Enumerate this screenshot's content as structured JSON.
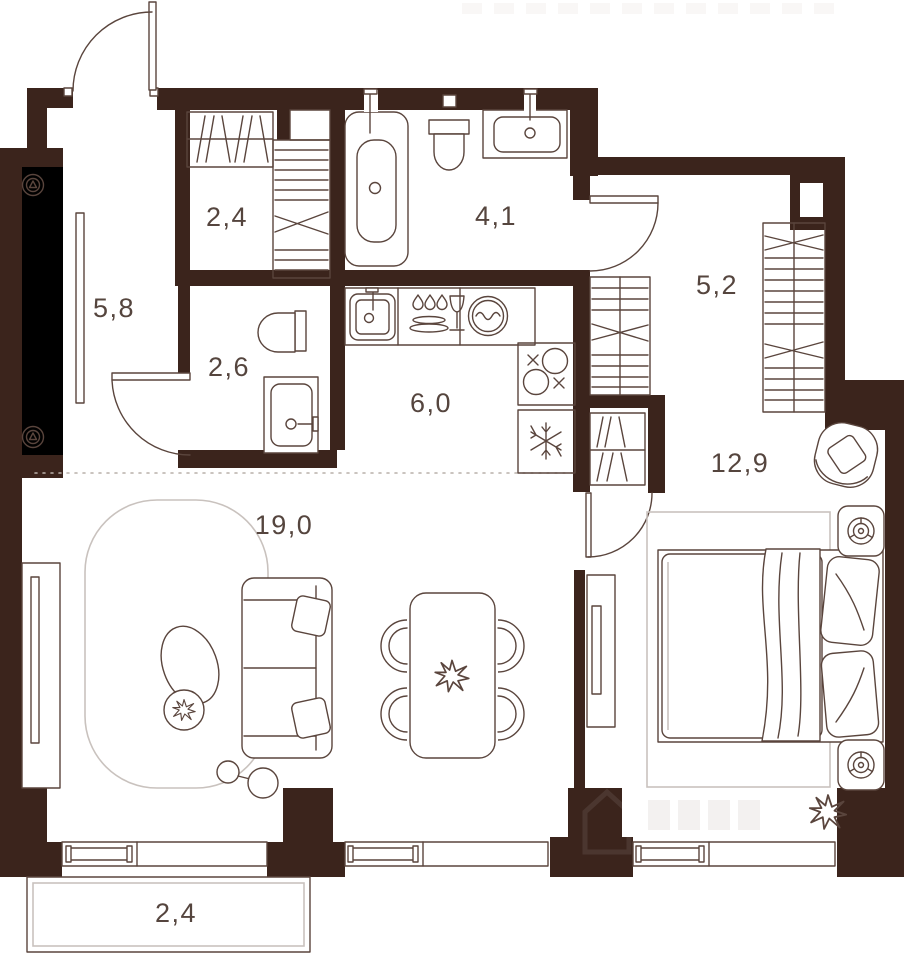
{
  "plan": {
    "name": "apartment-floor-plan",
    "colors": {
      "wall": "#3b241c",
      "furniture_line": "#5a453d",
      "light_line": "#c9c2be",
      "label": "#55453e",
      "background": "#ffffff"
    },
    "rooms": [
      {
        "id": "entry-hall",
        "label": "5,8"
      },
      {
        "id": "closet",
        "label": "2,4"
      },
      {
        "id": "bathroom",
        "label": "4,1"
      },
      {
        "id": "wc",
        "label": "2,6"
      },
      {
        "id": "kitchen",
        "label": "6,0"
      },
      {
        "id": "corridor",
        "label": "5,2"
      },
      {
        "id": "living-room",
        "label": "19,0"
      },
      {
        "id": "bedroom",
        "label": "12,9"
      },
      {
        "id": "balcony",
        "label": "2,4"
      }
    ],
    "icons": [
      "bathtub-icon",
      "toilet-icon",
      "sink-icon",
      "washing-machine-icon",
      "dishes-icon",
      "stove-icon",
      "snowflake-fridge-icon",
      "wardrobe-icon",
      "shelves-icon",
      "bed-icon",
      "pillow-icon",
      "sofa-icon",
      "dining-table-icon",
      "chair-icon",
      "armchair-icon",
      "plant-icon",
      "floor-lamp-icon",
      "tv-icon",
      "radiator-icon",
      "vent-icon",
      "lamp-icon"
    ]
  }
}
